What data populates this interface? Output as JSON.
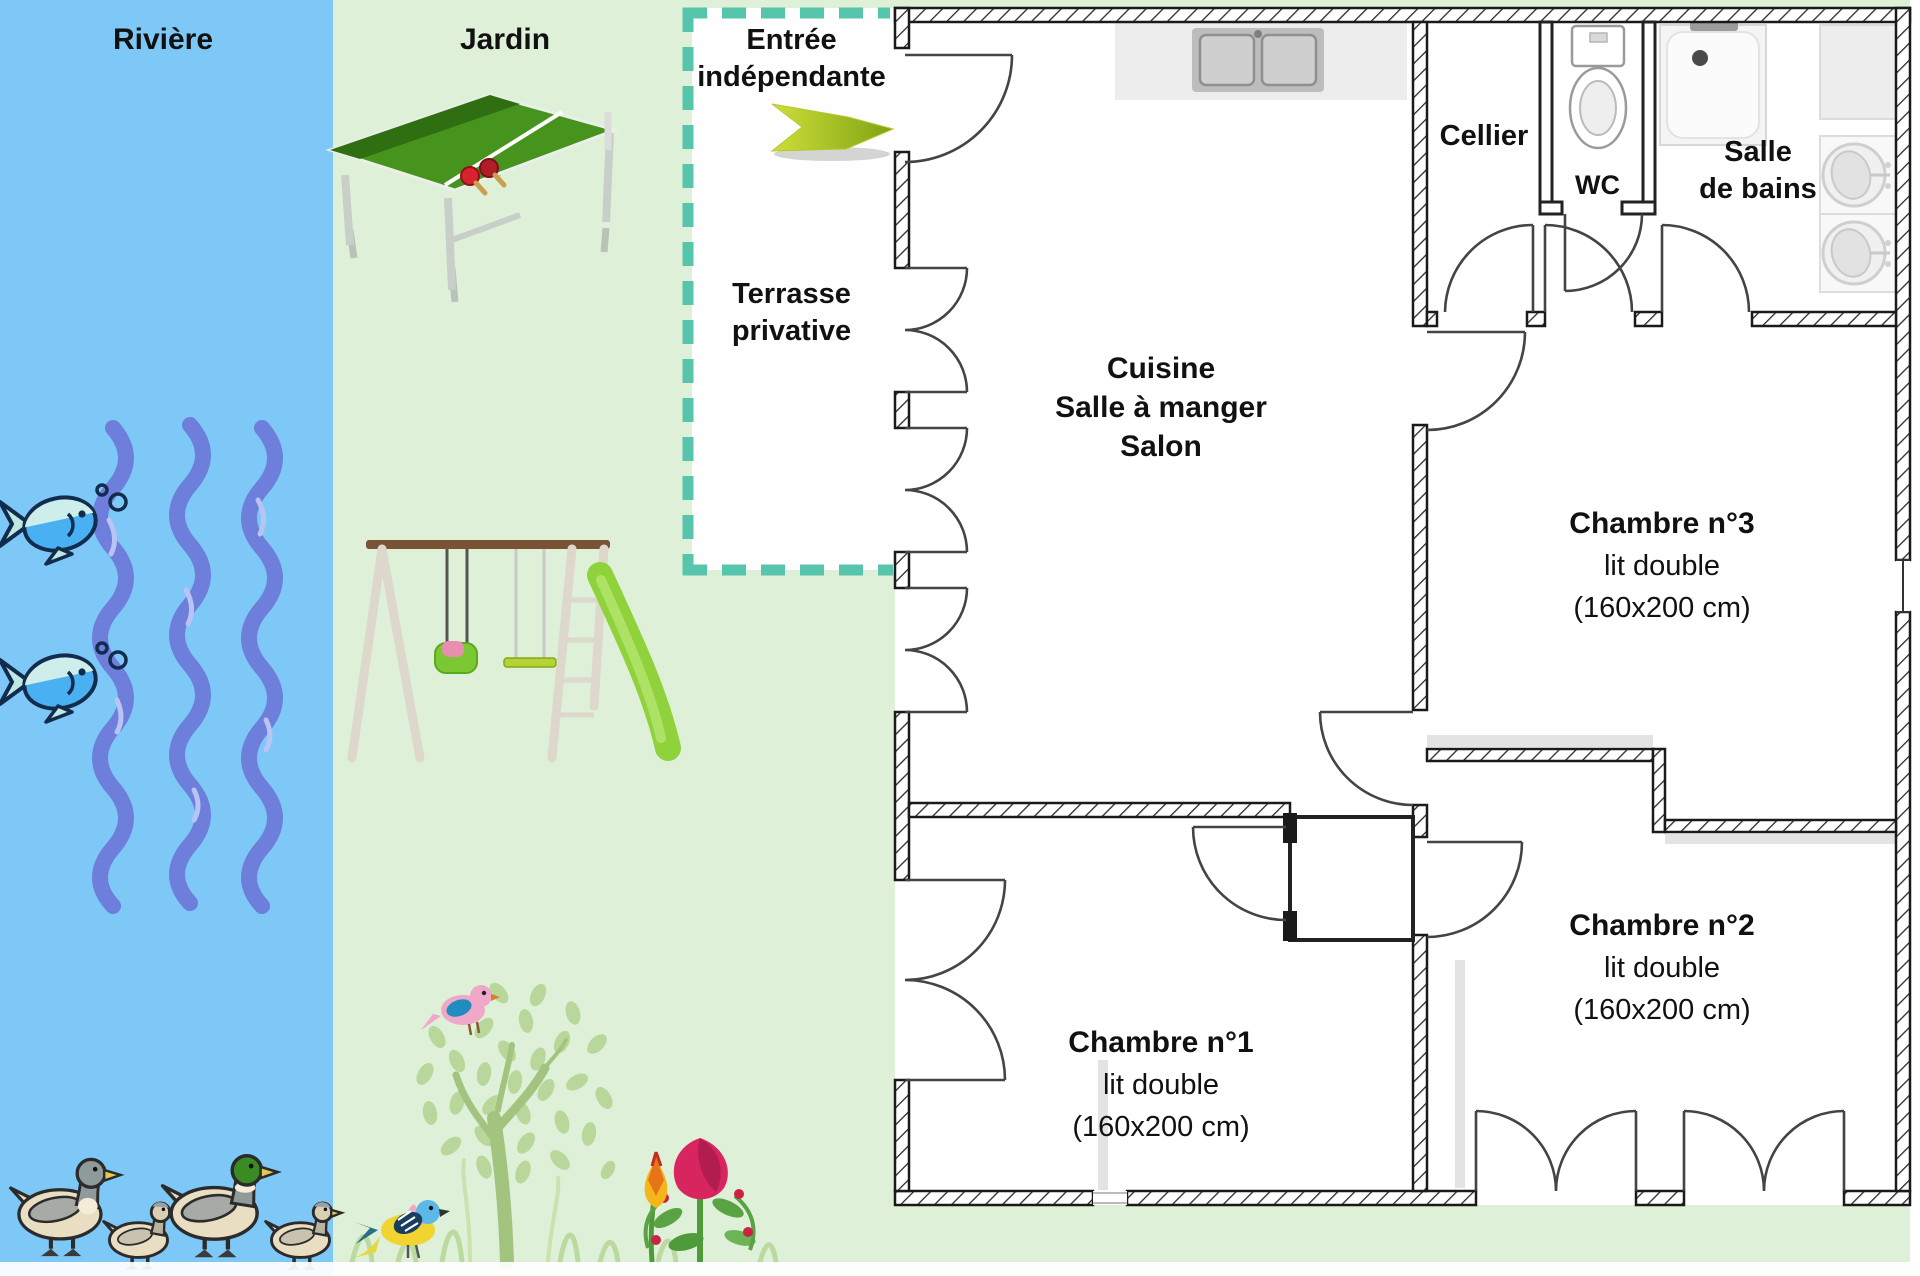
{
  "canvas": {
    "width": 1920,
    "height": 1276
  },
  "colors": {
    "river": "#7dc8f7",
    "garden": "#dff0d8",
    "terrace_border": "#56c5ab",
    "wave": "#6d7edb",
    "wall_outline": "#1a1a1a",
    "arrow_green": "#aacb2a",
    "label_text": "#111111"
  },
  "river": {
    "label": "Rivière",
    "fish_count": 2,
    "wave_count": 3,
    "duck_count": 4
  },
  "garden": {
    "label": "Jardin"
  },
  "terrace": {
    "entrance_line1": "Entrée",
    "entrance_line2": "indépendante",
    "label_line1": "Terrasse",
    "label_line2": "privative"
  },
  "plan": {
    "living": {
      "line1": "Cuisine",
      "line2": "Salle à manger",
      "line3": "Salon"
    },
    "cellier": {
      "label": "Cellier"
    },
    "wc": {
      "label": "WC"
    },
    "bathroom": {
      "line1": "Salle",
      "line2": "de bains"
    },
    "bedroom3": {
      "name": "Chambre n°3",
      "bed": "lit double",
      "dimensions": "(160x200 cm)"
    },
    "bedroom2": {
      "name": "Chambre n°2",
      "bed": "lit double",
      "dimensions": "(160x200 cm)"
    },
    "bedroom1": {
      "name": "Chambre n°1",
      "bed": "lit double",
      "dimensions": "(160x200 cm)"
    }
  }
}
